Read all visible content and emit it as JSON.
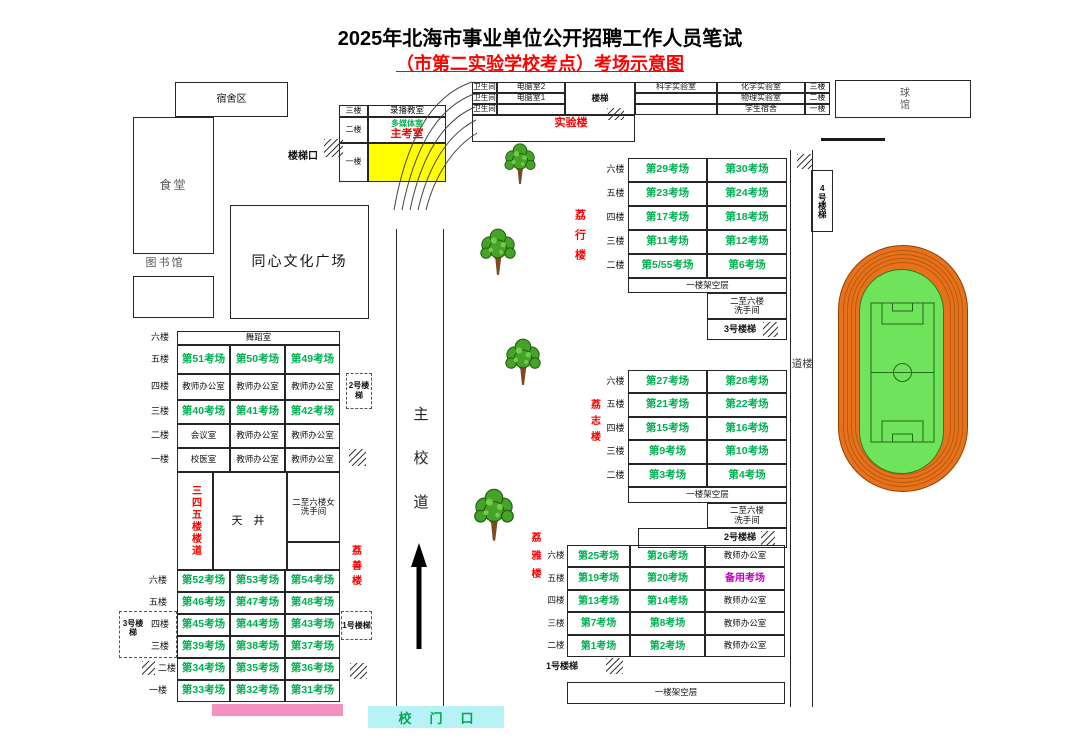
{
  "title": {
    "line1": "2025年北海市事业单位公开招聘工作人员笔试",
    "line2": "（市第二实验学校考点）考场示意图"
  },
  "facilities": {
    "dorm": "宿舍区",
    "canteen": "食堂",
    "library": "图书馆",
    "plaza": "同心文化广场",
    "ball_hall": "球馆"
  },
  "admin": {
    "f3": "三楼",
    "f3_room": "录播教室",
    "f2": "二楼",
    "f2_room_a": "多媒体室",
    "f2_room_b": "主考室",
    "f1": "一楼",
    "stair_entrance": "楼梯口"
  },
  "lab": {
    "name": "实验楼",
    "wc": "卫生间",
    "pc2": "电脑室2",
    "pc1": "电脑室1",
    "stairs": "楼梯",
    "sci": "科学实验室",
    "chem": "化学实验室",
    "phys": "物理实验室",
    "student_dorm": "学生宿舍",
    "f3": "三楼",
    "f2": "二楼",
    "f1": "一楼"
  },
  "lixing": {
    "name": "荔行楼",
    "floors": [
      "六楼",
      "五楼",
      "四楼",
      "三楼",
      "二楼"
    ],
    "rooms": [
      [
        "第29考场",
        "第30考场"
      ],
      [
        "第23考场",
        "第24考场"
      ],
      [
        "第17考场",
        "第18考场"
      ],
      [
        "第11考场",
        "第12考场"
      ],
      [
        "第5/55考场",
        "第6考场"
      ]
    ],
    "ground": "一楼架空层",
    "washroom1": "二至六楼",
    "washroom2": "洗手间",
    "stair3": "3号楼梯",
    "stair4": "4号楼梯"
  },
  "lizhi": {
    "name": "荔志楼",
    "floors": [
      "六楼",
      "五楼",
      "四楼",
      "三楼",
      "二楼"
    ],
    "rooms": [
      [
        "第27考场",
        "第28考场"
      ],
      [
        "第21考场",
        "第22考场"
      ],
      [
        "第15考场",
        "第16考场"
      ],
      [
        "第9考场",
        "第10考场"
      ],
      [
        "第3考场",
        "第4考场"
      ]
    ],
    "ground": "一楼架空层",
    "washroom1": "二至六楼",
    "washroom2": "洗手间",
    "stair2": "2号楼梯"
  },
  "liya": {
    "name": "荔雅楼",
    "floors": [
      "六楼",
      "五楼",
      "四楼",
      "三楼",
      "二楼"
    ],
    "rooms": [
      [
        "第25考场",
        "第26考场",
        "教师办公室"
      ],
      [
        "第19考场",
        "第20考场",
        "备用考场"
      ],
      [
        "第13考场",
        "第14考场",
        "教师办公室"
      ],
      [
        "第7考场",
        "第8考场",
        "教师办公室"
      ],
      [
        "第1考场",
        "第2考场",
        "教师办公室"
      ]
    ],
    "stair1": "1号楼梯",
    "ground": "一楼架空层"
  },
  "west": {
    "name": "荔善楼",
    "dance": "舞蹈室",
    "upper_floors": [
      "六楼",
      "五楼",
      "四楼",
      "三楼",
      "二楼",
      "一楼"
    ],
    "upper_rooms": [
      [
        "第51考场",
        "第50考场",
        "第49考场"
      ],
      [
        "教师办公室",
        "教师办公室",
        "教师办公室"
      ],
      [
        "第40考场",
        "第41考场",
        "第42考场"
      ],
      [
        "会议室",
        "教师办公室",
        "教师办公室"
      ],
      [
        "校医室",
        "教师办公室",
        "教师办公室"
      ]
    ],
    "corridor": "三四五楼楼道",
    "well": "天 井",
    "washroom1": "二至六楼女",
    "washroom2": "洗手间",
    "lower_floors": [
      "六楼",
      "五楼",
      "四楼",
      "三楼",
      "二楼",
      "一楼"
    ],
    "lower_rooms": [
      [
        "第52考场",
        "第53考场",
        "第54考场"
      ],
      [
        "第46考场",
        "第47考场",
        "第48考场"
      ],
      [
        "第45考场",
        "第44考场",
        "第43考场"
      ],
      [
        "第39考场",
        "第38考场",
        "第37考场"
      ],
      [
        "第34考场",
        "第35考场",
        "第36考场"
      ],
      [
        "第33考场",
        "第32考场",
        "第31考场"
      ]
    ],
    "stair2": "2号楼梯",
    "stair3": "3号楼梯",
    "stair1": "1号楼梯"
  },
  "roads": {
    "main": "主校道",
    "side": "楼道",
    "gate": "校门口"
  },
  "colors": {
    "exam_green": "#00B050",
    "label_red": "#FF0000",
    "reserve_purple": "#C000C0",
    "main_room_yellow": "#FFFF00",
    "gate_cyan": "#B7F3F6",
    "gate_text": "#00A650",
    "pink_bar": "#F591BE",
    "track_orange": "#E8711C",
    "track_lane": "#B85A10",
    "field_green": "#70E35C"
  }
}
